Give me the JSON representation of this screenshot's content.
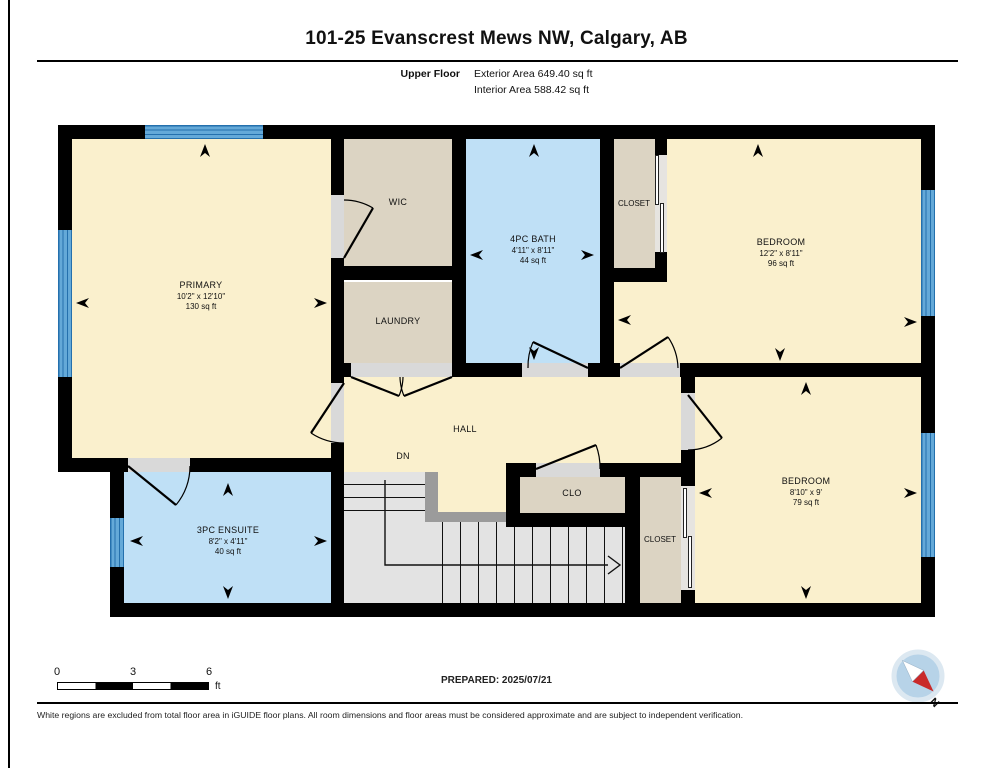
{
  "page": {
    "title": "101-25 Evanscrest Mews NW, Calgary, AB",
    "floor_label": "Upper Floor",
    "exterior_area": "Exterior Area 649.40 sq ft",
    "interior_area": "Interior Area 588.42 sq ft",
    "prepared_label": "PREPARED: 2025/07/21",
    "disclaimer": "White regions are excluded from total floor area in iGUIDE floor plans. All room dimensions and floor areas must be considered approximate and are subject to independent verification.",
    "compass_label": "N"
  },
  "scale_bar": {
    "ticks": [
      "0",
      "3",
      "6"
    ],
    "unit": "ft"
  },
  "rooms": {
    "primary": {
      "name": "PRIMARY",
      "dims": "10'2\" x 12'10\"",
      "area": "130 sq ft"
    },
    "wic": {
      "name": "WIC"
    },
    "bath": {
      "name": "4PC BATH",
      "dims": "4'11\" x 8'11\"",
      "area": "44 sq ft"
    },
    "closet_top": {
      "name": "CLOSET"
    },
    "bedroom_top": {
      "name": "BEDROOM",
      "dims": "12'2\" x 8'11\"",
      "area": "96 sq ft"
    },
    "laundry": {
      "name": "LAUNDRY"
    },
    "hall": {
      "name": "HALL"
    },
    "stairs": {
      "label": "DN"
    },
    "clo": {
      "name": "CLO"
    },
    "ensuite": {
      "name": "3PC ENSUITE",
      "dims": "8'2\" x 4'11\"",
      "area": "40 sq ft"
    },
    "closet_bottom": {
      "name": "CLOSET"
    },
    "bedroom_bottom": {
      "name": "BEDROOM",
      "dims": "8'10\" x 9'",
      "area": "79 sq ft"
    }
  },
  "colors": {
    "room_cream": "#FAF0CD",
    "room_tan": "#DCD4C3",
    "room_blue": "#BFE0F6",
    "window_blue": "#64A9D8",
    "window_line": "#2470AD",
    "wall": "#000000",
    "stairs": "#E3E3E3",
    "railing": "#9B9B9B",
    "door_opening": "#D9D9D9",
    "compass_red": "#C92A2A",
    "compass_blue": "#B7D3E8"
  }
}
